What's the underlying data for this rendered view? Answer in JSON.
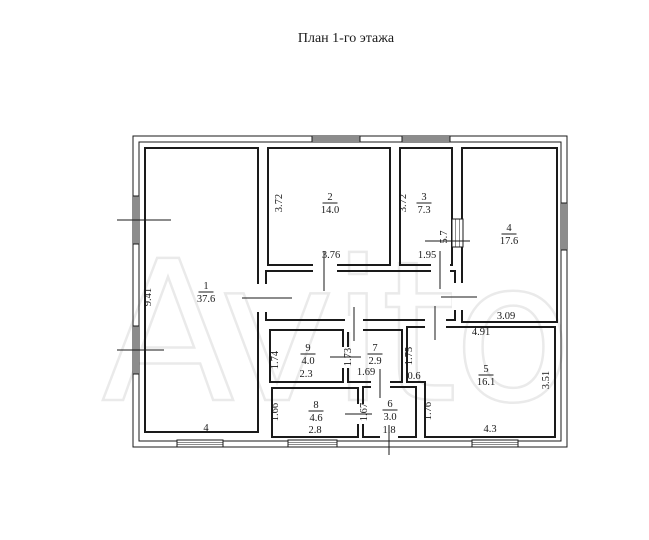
{
  "title": "План 1-го этажа",
  "watermark_text": "Avito",
  "colors": {
    "background": "#ffffff",
    "wall": "#1a1a1a",
    "watermark": "#eaeaea"
  },
  "floorplan": {
    "canvas": {
      "width": 649,
      "height": 540
    },
    "envelope": {
      "outer": [
        133,
        136,
        434,
        311
      ],
      "inner": [
        139,
        142,
        422,
        299
      ]
    },
    "corridor": {
      "rect": [
        266,
        271,
        189,
        49
      ]
    },
    "rooms": [
      {
        "number": "1",
        "area": "37.6",
        "label": [
          206,
          289
        ],
        "rect": [
          145,
          148,
          113,
          284
        ]
      },
      {
        "number": "2",
        "area": "14.0",
        "label": [
          330,
          200
        ],
        "rect": [
          268,
          148,
          122,
          117
        ]
      },
      {
        "number": "3",
        "area": "7.3",
        "label": [
          424,
          200
        ],
        "rect": [
          400,
          148,
          52,
          117
        ]
      },
      {
        "number": "4",
        "area": "17.6",
        "label": [
          509,
          231
        ],
        "rect": [
          462,
          148,
          95,
          174
        ]
      },
      {
        "number": "5",
        "area": "16.1",
        "label": [
          486,
          372
        ],
        "poly": [
          [
            407,
            327
          ],
          [
            555,
            327
          ],
          [
            555,
            437
          ],
          [
            425,
            437
          ],
          [
            425,
            382
          ],
          [
            407,
            382
          ]
        ]
      },
      {
        "number": "6",
        "area": "3.0",
        "label": [
          390,
          407
        ],
        "rect": [
          363,
          387,
          53,
          50
        ]
      },
      {
        "number": "7",
        "area": "2.9",
        "label": [
          375,
          351
        ],
        "rect": [
          348,
          330,
          54,
          52
        ]
      },
      {
        "number": "8",
        "area": "4.6",
        "label": [
          316,
          408
        ],
        "rect": [
          272,
          388,
          86,
          49
        ]
      },
      {
        "number": "9",
        "area": "4.0",
        "label": [
          308,
          351
        ],
        "rect": [
          270,
          330,
          73,
          52
        ]
      }
    ],
    "dimensions": [
      {
        "text": "9.41",
        "x": 151,
        "y": 297,
        "vertical": true
      },
      {
        "text": "4",
        "x": 206,
        "y": 431,
        "vertical": false
      },
      {
        "text": "3.72",
        "x": 282,
        "y": 203,
        "vertical": true
      },
      {
        "text": "3.76",
        "x": 331,
        "y": 258,
        "vertical": false
      },
      {
        "text": "3.72",
        "x": 406,
        "y": 203,
        "vertical": true
      },
      {
        "text": "1.95",
        "x": 427,
        "y": 258,
        "vertical": false
      },
      {
        "text": "5.7",
        "x": 447,
        "y": 237,
        "vertical": true
      },
      {
        "text": "3.09",
        "x": 506,
        "y": 319,
        "vertical": false
      },
      {
        "text": "4.91",
        "x": 481,
        "y": 335,
        "vertical": false
      },
      {
        "text": "1.75",
        "x": 412,
        "y": 356,
        "vertical": true
      },
      {
        "text": "0.6",
        "x": 414,
        "y": 379,
        "vertical": false
      },
      {
        "text": "3.51",
        "x": 549,
        "y": 380,
        "vertical": true
      },
      {
        "text": "1.76",
        "x": 431,
        "y": 411,
        "vertical": true
      },
      {
        "text": "1.74",
        "x": 278,
        "y": 360,
        "vertical": true
      },
      {
        "text": "2.3",
        "x": 306,
        "y": 377,
        "vertical": false
      },
      {
        "text": "1.73",
        "x": 351,
        "y": 357,
        "vertical": true
      },
      {
        "text": "1.69",
        "x": 366,
        "y": 375,
        "vertical": false
      },
      {
        "text": "1.66",
        "x": 278,
        "y": 412,
        "vertical": true
      },
      {
        "text": "2.8",
        "x": 315,
        "y": 433,
        "vertical": false
      },
      {
        "text": "1.67",
        "x": 367,
        "y": 412,
        "vertical": true
      },
      {
        "text": "1.8",
        "x": 389,
        "y": 433,
        "vertical": false
      },
      {
        "text": "4.3",
        "x": 490,
        "y": 432,
        "vertical": false
      }
    ],
    "doors": [
      {
        "name": "door-room1-corridor",
        "gap": [
          254,
          284,
          15,
          28
        ],
        "tick": [
          242,
          298,
          292,
          298
        ]
      },
      {
        "name": "door-room2-corridor",
        "gap": [
          313,
          261,
          24,
          14
        ],
        "tick": [
          324,
          251,
          324,
          291
        ]
      },
      {
        "name": "door-room3-corridor",
        "gap": [
          431,
          261,
          19,
          14
        ],
        "tick": [
          440,
          251,
          440,
          289
        ]
      },
      {
        "name": "door-corridor-room4",
        "gap": [
          452,
          283,
          12,
          27
        ],
        "tick": [
          441,
          297,
          477,
          297
        ]
      },
      {
        "name": "door-corridor-room5",
        "gap": [
          425,
          316,
          21,
          13
        ],
        "tick": [
          435,
          306,
          435,
          340
        ]
      },
      {
        "name": "door-corridor-room7",
        "gap": [
          345,
          316,
          18,
          16
        ],
        "tick": [
          354,
          307,
          354,
          341
        ]
      },
      {
        "name": "door-room9-room7",
        "gap": [
          341,
          347,
          9,
          21
        ],
        "tick": [
          330,
          357,
          361,
          357
        ]
      },
      {
        "name": "door-room8-room6",
        "gap": [
          356,
          404,
          9,
          20
        ],
        "tick": [
          345,
          414,
          372,
          414
        ]
      },
      {
        "name": "door-room7-room6",
        "gap": [
          371,
          380,
          19,
          9
        ],
        "tick": [
          380,
          369,
          380,
          398
        ]
      },
      {
        "name": "door-entrance",
        "gap": [
          380,
          434,
          18,
          5
        ],
        "tick": [
          389,
          425,
          389,
          455
        ]
      }
    ],
    "windows": [
      {
        "rect": [
          312,
          136,
          48,
          6
        ],
        "orient": "h"
      },
      {
        "rect": [
          402,
          136,
          48,
          6
        ],
        "orient": "h"
      },
      {
        "rect": [
          133,
          196,
          6,
          48
        ],
        "orient": "v",
        "axis": [
          117,
          220,
          171,
          220
        ]
      },
      {
        "rect": [
          133,
          326,
          6,
          48
        ],
        "orient": "v",
        "axis": [
          117,
          350,
          164,
          350
        ]
      },
      {
        "rect": [
          561,
          203,
          6,
          47
        ],
        "orient": "v"
      },
      {
        "rect": [
          452,
          219,
          11,
          28
        ],
        "orient": "v",
        "axis": [
          425,
          241,
          470,
          241
        ]
      },
      {
        "rect": [
          177,
          440,
          46,
          7
        ],
        "orient": "h"
      },
      {
        "rect": [
          288,
          440,
          49,
          7
        ],
        "orient": "h"
      },
      {
        "rect": [
          472,
          440,
          46,
          7
        ],
        "orient": "h"
      }
    ]
  }
}
